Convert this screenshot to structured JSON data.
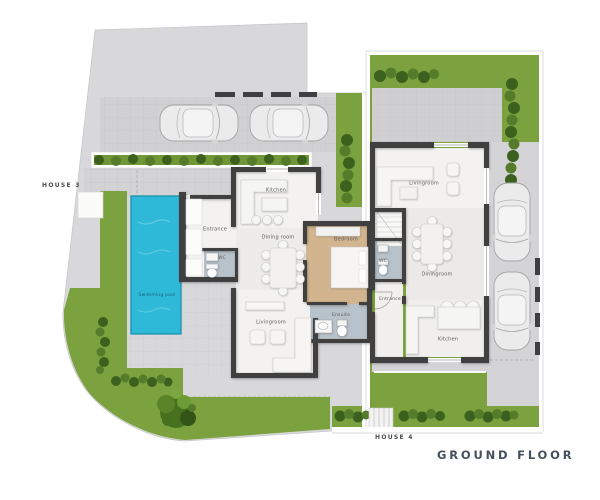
{
  "title": "GROUND FLOOR",
  "house3": {
    "label": "HOUSE 3",
    "rooms": {
      "kitchen": "Kitchen",
      "entrance": "Entrance",
      "dining": "Dining room",
      "wc": "WC",
      "bedroom": "Bedroom",
      "ensuite": "Ensuite",
      "living": "Livingroom",
      "pool": "Swimming pool"
    }
  },
  "house4": {
    "label": "HOUSE 4",
    "rooms": {
      "living": "Livingroom",
      "dining": "Diningroom",
      "wc": "WC",
      "entrance": "Entrance",
      "kitchen": "Kitchen"
    }
  },
  "colors": {
    "grass": "#7ba23e",
    "hedge_dark": "#3c611e",
    "pool_water": "#2fb9d8",
    "wall": "#3f3f41",
    "paving": "#d8d8da",
    "paving_dark": "#d1d1d3",
    "wood_floor": "#d2b58f",
    "bath_floor": "#b8c2ca",
    "label_text": "#5c5c5e"
  }
}
